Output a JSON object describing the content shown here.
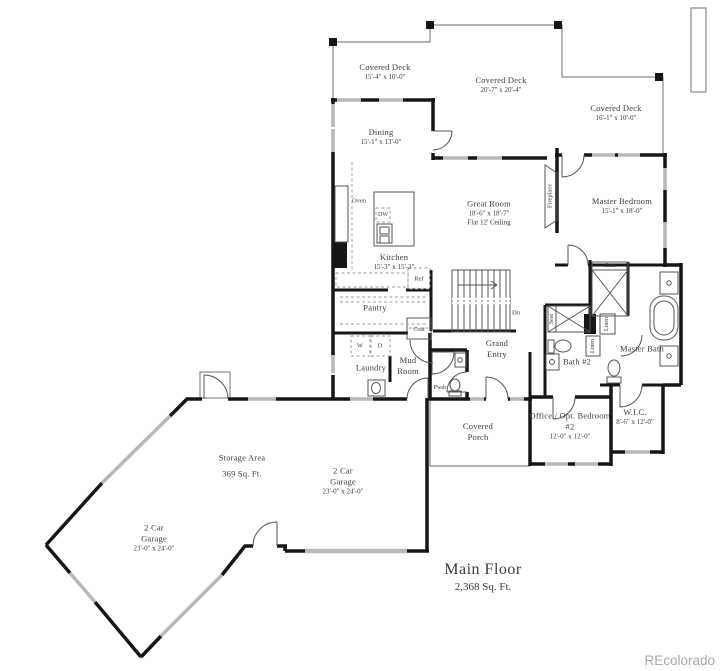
{
  "title": {
    "name": "Main Floor",
    "area": "2,368 Sq. Ft."
  },
  "watermark": "REcolorado",
  "rooms": {
    "deck_left": {
      "label": "Covered Deck",
      "dims": "15'-4\" x 10'-0\""
    },
    "deck_center": {
      "label": "Covered Deck",
      "dims": "20'-7\" x 20'-4\""
    },
    "deck_right": {
      "label": "Covered Deck",
      "dims": "16'-1\" x 10'-0\""
    },
    "dining": {
      "label": "Dining",
      "dims": "15'-1\" x 13'-0\""
    },
    "great_room": {
      "label": "Great Room",
      "dims": "18'-6\" x 18'-7\"",
      "note": "Flat 12' Ceiling"
    },
    "master_bedroom": {
      "label": "Master Bedroom",
      "dims": "15'-1\" x 18'-0\""
    },
    "kitchen": {
      "label": "Kitchen",
      "dims": "15'-3\" x 15'-3\""
    },
    "pantry": {
      "label": "Pantry"
    },
    "laundry": {
      "label": "Laundry"
    },
    "mud_room": {
      "label": "Mud Room"
    },
    "grand_entry": {
      "label": "Grand Entry"
    },
    "covered_porch": {
      "label": "Covered Porch"
    },
    "office": {
      "label": "Office / Opt. Bedroom #2",
      "dims": "12'-0\" x 12'-0\""
    },
    "wic": {
      "label": "W.I.C.",
      "dims": "8'-6\" x 12'-0\""
    },
    "master_bath": {
      "label": "Master Bath"
    },
    "bath_2": {
      "label": "Bath #2"
    },
    "storage": {
      "label": "Storage Area",
      "dims": "369 Sq. Ft."
    },
    "garage_right": {
      "label": "2 Car Garage",
      "dims": "23'-0\" x 24'-0\""
    },
    "garage_left": {
      "label": "2 Car Garage",
      "dims": "23'-0\" x 24'-0\""
    }
  },
  "fixtures": {
    "oven": "Oven",
    "dishwasher": "DW",
    "refrigerator": "Ref",
    "washer": "W",
    "dryer": "D",
    "powder": "Pwdr",
    "coat": "Coat",
    "fireplace": "Fireplace",
    "stairs_down": "Dn",
    "seat": "Seat",
    "linen": "Linen"
  }
}
